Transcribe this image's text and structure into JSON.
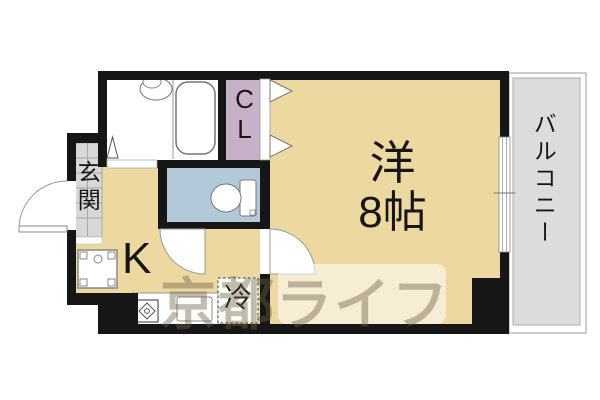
{
  "floorplan": {
    "type": "1K apartment floor plan",
    "rooms": {
      "main_room": {
        "label_line1": "洋",
        "label_line2": "8帖",
        "size": "8帖"
      },
      "kitchen": {
        "label": "K"
      },
      "closet": {
        "label": "CL"
      },
      "entrance": {
        "label": "玄関"
      },
      "balcony": {
        "label": "バルコニー"
      },
      "refrigerator_space": {
        "label": "冷"
      }
    },
    "watermark": {
      "text": "京都ライフ"
    },
    "colors": {
      "wall": "#161616",
      "room": "#ecd8a0",
      "toilet": "#b2c9da",
      "closet": "#c6b1c8",
      "balcony": "#dcdcdc",
      "tile": "#d8d8d8",
      "white": "#ffffff"
    }
  }
}
